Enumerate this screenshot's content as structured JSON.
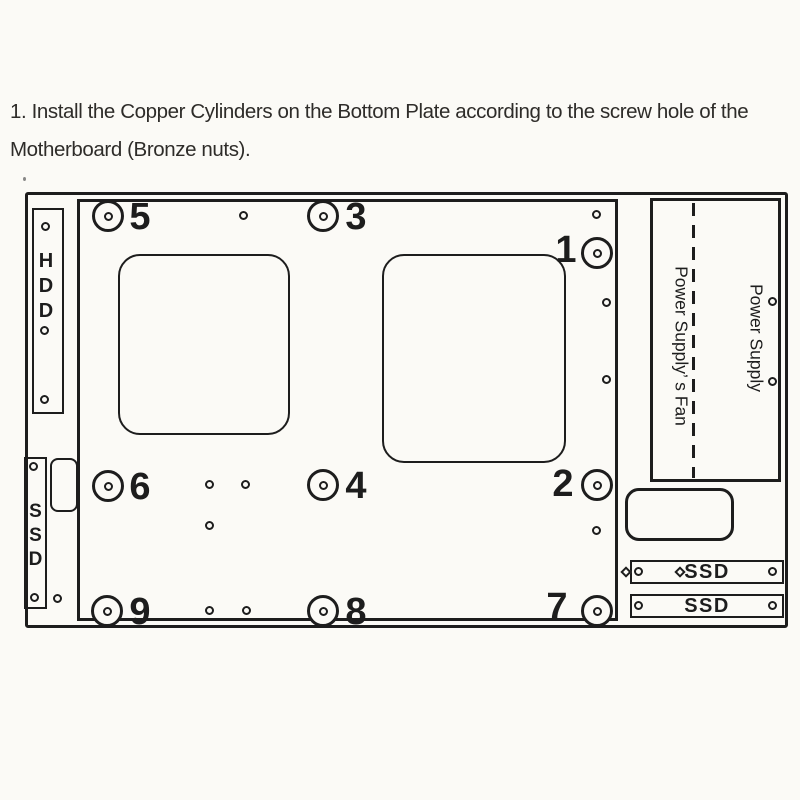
{
  "instruction": {
    "line1": "1. Install the Copper Cylinders on the Bottom Plate according to the screw hole of the",
    "line2": "Motherboard (Bronze nuts)."
  },
  "diagram": {
    "hdd_label": "HDD",
    "ssd_left_label": "SSD",
    "power_supply_fan_label": "Power Supply’ s Fan",
    "power_supply_label": "Power Supply",
    "ssd_bay_top_label": "SSD",
    "ssd_bay_bottom_label": "SSD",
    "screw_labels": [
      "5",
      "3",
      "1",
      "6",
      "4",
      "2",
      "9",
      "8",
      "7"
    ]
  },
  "colors": {
    "line": "#1d1d1d",
    "background": "#fbfaf6",
    "text": "#2e2c29"
  }
}
